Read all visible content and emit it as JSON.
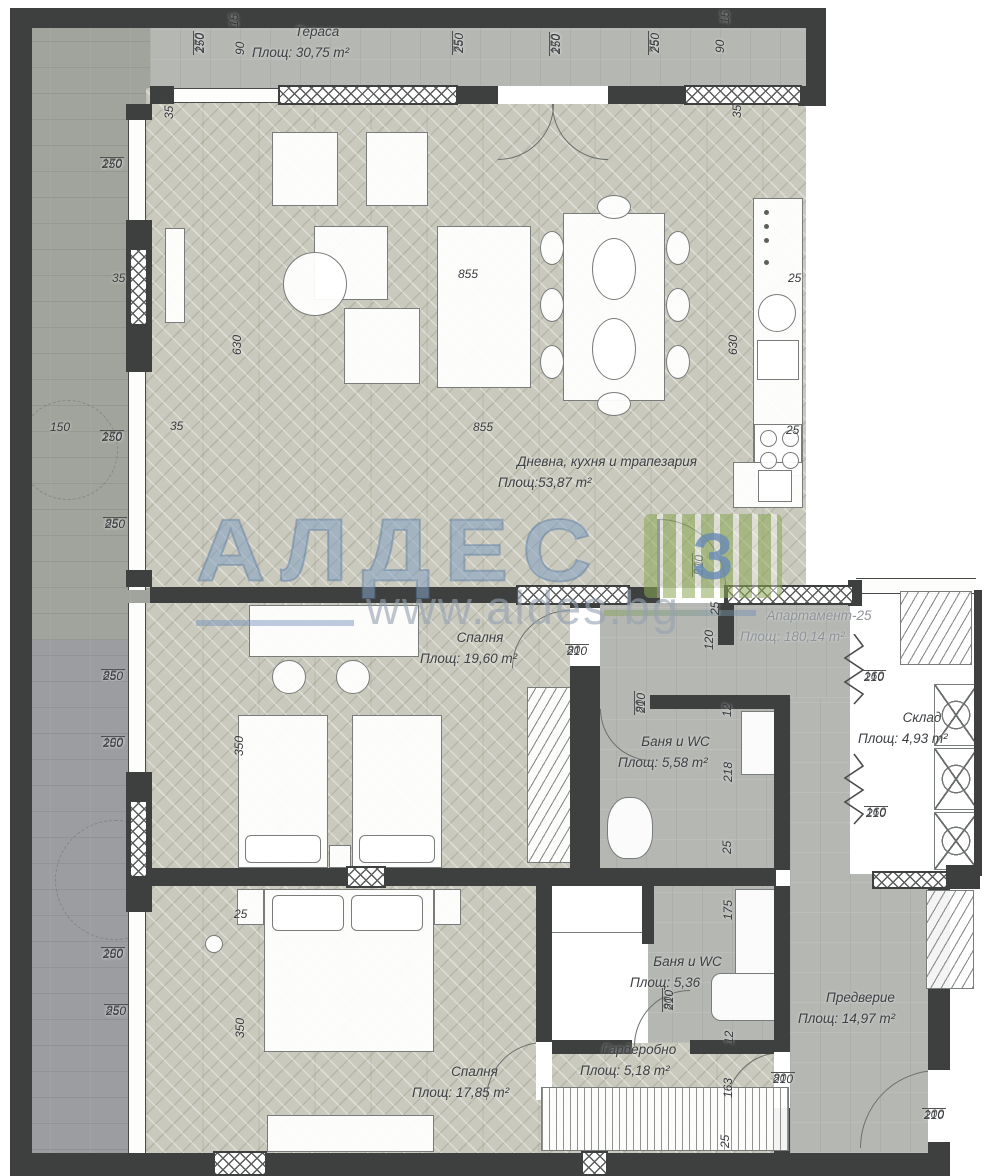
{
  "plan": {
    "watermark": {
      "brand": "АЛДЕС",
      "mark": "З",
      "url": "www.aldes.bg"
    },
    "rooms": [
      {
        "id": "terrace",
        "name": "Тераса",
        "area": "Площ: 30,75 m²",
        "x": 252,
        "y": 22,
        "w": 130
      },
      {
        "id": "living",
        "name": "Дневна, кухня и трапезария",
        "area_label": "Площ:",
        "area_value": "53,87 m²",
        "x": 498,
        "y": 452,
        "w": 218
      },
      {
        "id": "bedroom1",
        "name": "Спалня",
        "area": "Площ: 19,60 m²",
        "x": 420,
        "y": 628,
        "w": 120
      },
      {
        "id": "bath1",
        "name": "Баня и WC",
        "area": "Площ: 5,58 m²",
        "x": 618,
        "y": 732,
        "w": 115
      },
      {
        "id": "apartment",
        "name": "Апартамент-25",
        "area": "Площ: 180,14 m²",
        "x": 740,
        "y": 606,
        "w": 158,
        "muted": true
      },
      {
        "id": "sklad",
        "name": "Склад",
        "area": "Площ: 4,93 m²",
        "x": 858,
        "y": 708,
        "w": 128
      },
      {
        "id": "bath2",
        "name": "Баня и WC",
        "area": "Площ: 5,36",
        "x": 630,
        "y": 952,
        "w": 115
      },
      {
        "id": "garderob",
        "name": "Гардеробно",
        "area": "Площ: 5,18 m²",
        "x": 580,
        "y": 1040,
        "w": 118
      },
      {
        "id": "predverie",
        "name": "Предверие",
        "area": "Площ: 14,97 m²",
        "x": 798,
        "y": 988,
        "w": 125
      },
      {
        "id": "bedroom2",
        "name": "Спалня",
        "area": "Площ: 17,85 m²",
        "x": 412,
        "y": 1062,
        "w": 125
      }
    ],
    "dims": [
      {
        "a": "170",
        "b": "250",
        "x": 193,
        "y": 55,
        "rot": true
      },
      {
        "a": "15",
        "x": 228,
        "y": 29,
        "rot": true
      },
      {
        "a": "90",
        "x": 234,
        "y": 57,
        "rot": true
      },
      {
        "a": "75",
        "b": "250",
        "x": 452,
        "y": 55,
        "rot": true
      },
      {
        "a": "170",
        "b": "250",
        "x": 549,
        "y": 56,
        "rot": true
      },
      {
        "a": "75",
        "b": "250",
        "x": 648,
        "y": 55,
        "rot": true
      },
      {
        "a": "90",
        "x": 714,
        "y": 55,
        "rot": true
      },
      {
        "a": "15",
        "x": 719,
        "y": 26,
        "rot": true
      },
      {
        "a": "35",
        "x": 163,
        "y": 121,
        "rot": true
      },
      {
        "a": "35",
        "x": 731,
        "y": 120,
        "rot": true
      },
      {
        "a": "170",
        "b": "250",
        "x": 100,
        "y": 157
      },
      {
        "a": "35",
        "x": 110,
        "y": 272
      },
      {
        "a": "630",
        "x": 231,
        "y": 357,
        "rot": true
      },
      {
        "a": "630",
        "x": 727,
        "y": 357,
        "rot": true
      },
      {
        "a": "855",
        "x": 456,
        "y": 268
      },
      {
        "a": "25",
        "x": 786,
        "y": 272
      },
      {
        "a": "150",
        "x": 48,
        "y": 421
      },
      {
        "a": "170",
        "b": "250",
        "x": 100,
        "y": 430
      },
      {
        "a": "35",
        "x": 168,
        "y": 420
      },
      {
        "a": "855",
        "x": 471,
        "y": 421
      },
      {
        "a": "25",
        "x": 784,
        "y": 424
      },
      {
        "a": "85",
        "b": "250",
        "x": 103,
        "y": 517
      },
      {
        "a": "90",
        "b": "210",
        "x": 692,
        "y": 577,
        "rot": true
      },
      {
        "a": "25",
        "x": 709,
        "y": 617,
        "rot": true
      },
      {
        "a": "120",
        "x": 703,
        "y": 652,
        "rot": true
      },
      {
        "a": "80",
        "b": "210",
        "x": 565,
        "y": 644
      },
      {
        "a": "85",
        "b": "250",
        "x": 101,
        "y": 669
      },
      {
        "a": "160",
        "b": "210",
        "x": 862,
        "y": 670
      },
      {
        "a": "80",
        "b": "210",
        "x": 634,
        "y": 715,
        "rot": true
      },
      {
        "a": "12",
        "x": 721,
        "y": 719,
        "rot": true
      },
      {
        "a": "100",
        "b": "250",
        "x": 101,
        "y": 736
      },
      {
        "a": "218",
        "x": 722,
        "y": 784,
        "rot": true
      },
      {
        "a": "160",
        "b": "210",
        "x": 864,
        "y": 806
      },
      {
        "a": "25",
        "x": 721,
        "y": 856,
        "rot": true
      },
      {
        "a": "175",
        "x": 722,
        "y": 922,
        "rot": true
      },
      {
        "a": "25",
        "x": 232,
        "y": 908
      },
      {
        "a": "100",
        "b": "250",
        "x": 101,
        "y": 947
      },
      {
        "a": "85",
        "b": "250",
        "x": 104,
        "y": 1004
      },
      {
        "a": "80",
        "b": "210",
        "x": 662,
        "y": 1012,
        "rot": true
      },
      {
        "a": "12",
        "x": 723,
        "y": 1046,
        "rot": true
      },
      {
        "a": "350",
        "x": 233,
        "y": 758,
        "rot": true
      },
      {
        "a": "350",
        "x": 234,
        "y": 1040,
        "rot": true
      },
      {
        "a": "80",
        "b": "210",
        "x": 771,
        "y": 1072
      },
      {
        "a": "163",
        "x": 722,
        "y": 1100,
        "rot": true
      },
      {
        "a": "25",
        "x": 719,
        "y": 1150,
        "rot": true
      },
      {
        "a": "100",
        "b": "210",
        "x": 922,
        "y": 1108
      }
    ]
  }
}
